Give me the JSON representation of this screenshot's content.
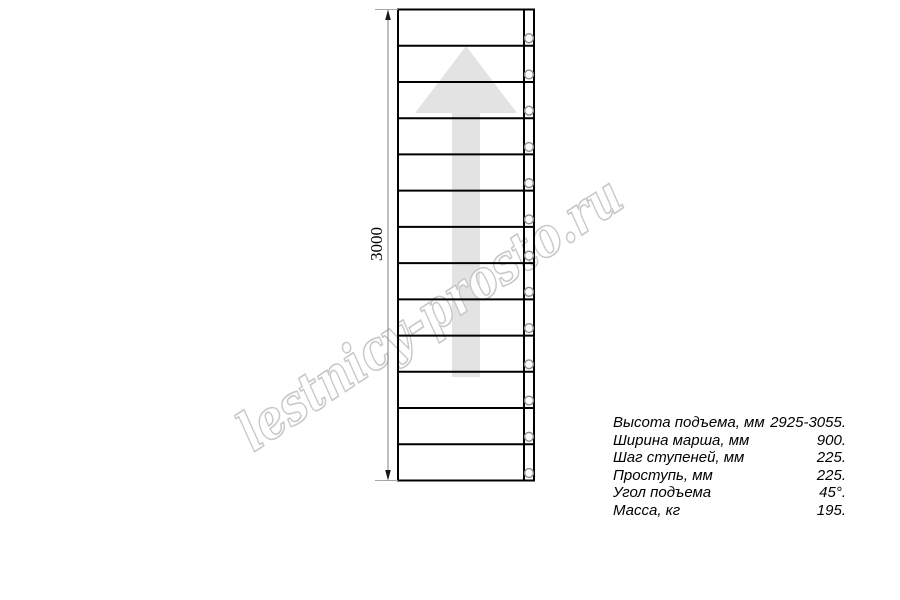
{
  "watermark": {
    "text": "lestnicy-prosto.ru",
    "stroke_color": "#c8c8c8"
  },
  "drawing": {
    "type": "stair-flight-plan-view",
    "dimension_label": "3000",
    "steps_count": 13,
    "arrow_direction": "up",
    "colors": {
      "line": "#000000",
      "arrow_fill": "#e3e3e3",
      "dim_line": "#808080",
      "ext_line": "#a6a6a6",
      "dim_arrow": "#1a1a1a",
      "hole_stroke": "#8c8c8c"
    }
  },
  "specs": [
    {
      "label": "Высота подъема, мм",
      "value": "2925-3055."
    },
    {
      "label": "Ширина марша, мм",
      "value": "900."
    },
    {
      "label": "Шаг ступеней, мм",
      "value": "225."
    },
    {
      "label": "Проступь, мм",
      "value": "225."
    },
    {
      "label": "Угол подъема",
      "value": "45°."
    },
    {
      "label": "Масса, кг",
      "value": "195."
    }
  ]
}
